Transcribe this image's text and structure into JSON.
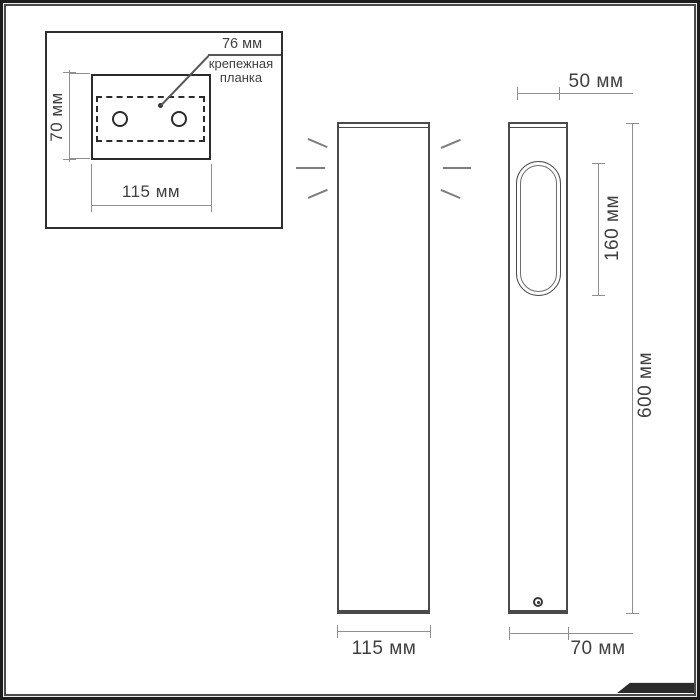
{
  "colors": {
    "outline_dark": "#2b2b2b",
    "outline_medium": "#4a4a4a",
    "dimension_line": "#8f8f8f",
    "text": "#3f3f3f",
    "background": "#ffffff",
    "frame": "#1c1c1c"
  },
  "inset": {
    "plate_height_label": "70 мм",
    "plate_width_label": "115 мм",
    "holes_spacing_label": "76 мм",
    "part_label_line1": "крепежная",
    "part_label_line2": "планка"
  },
  "front_view": {
    "width_label": "115 мм"
  },
  "side_view": {
    "top_width_label": "50 мм",
    "window_height_label": "160 мм",
    "total_height_label": "600 мм",
    "depth_label": "70 мм"
  }
}
